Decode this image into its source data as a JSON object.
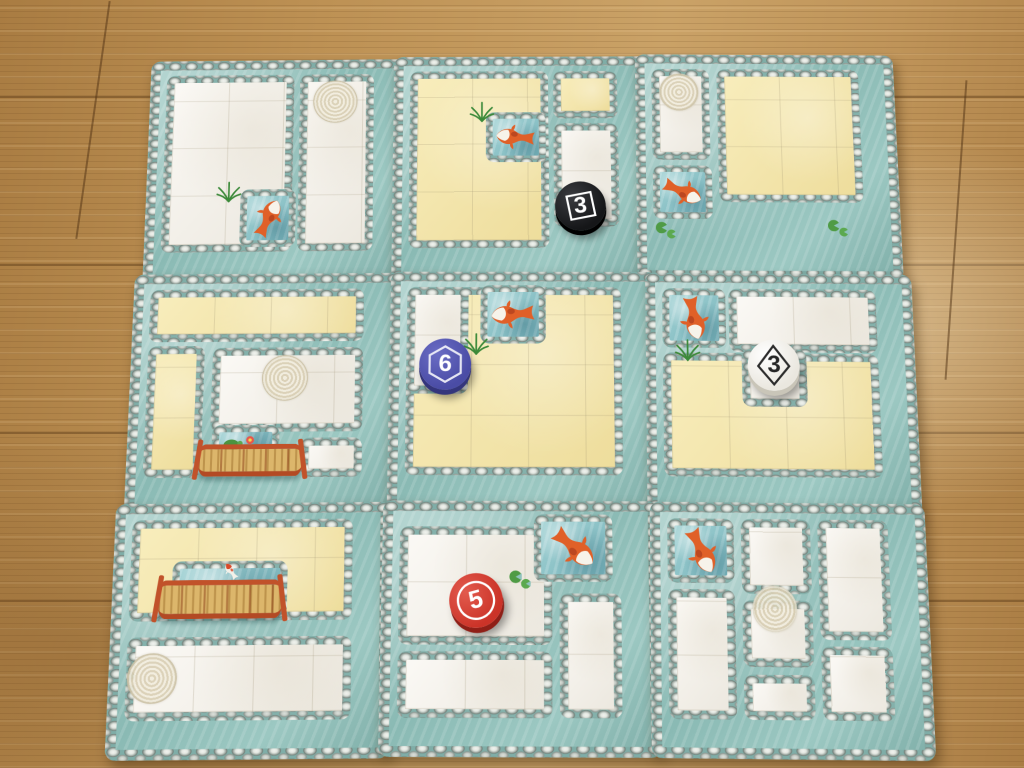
{
  "palette": {
    "floor": "#bd9154",
    "floor_dark": "#8f6536",
    "tile_water": "#9ac5c0",
    "pebble_gray": "#99a39e",
    "pebble_light": "#e4e8e4",
    "garden_white": "#f5f2ec",
    "garden_yellow": "#f3e5a9",
    "token_black": "#1b1c1e",
    "token_blue": "#5254ae",
    "token_white": "#f4f1ea",
    "token_red": "#d23b30",
    "bridge_rail": "#c1522a",
    "bridge_deck": "#dcb66b",
    "koi_orange": "#e06028"
  },
  "board": {
    "rows": 3,
    "cols": 3,
    "tiles": [
      {
        "id": "tile-a",
        "row": 0,
        "col": 0,
        "regions": [
          {
            "x": 0.12,
            "y": 0.12,
            "w": 2.32,
            "h": 3.76,
            "fill": "white"
          },
          {
            "x": 2.54,
            "y": 0.12,
            "w": 1.34,
            "h": 3.76,
            "fill": "white"
          }
        ],
        "features": [
          {
            "type": "spiral",
            "x": 3.18,
            "y": 0.72,
            "r": 0.44
          },
          {
            "type": "pond",
            "x": 1.52,
            "y": 2.58,
            "w": 0.98,
            "h": 1.2,
            "rot": 25
          },
          {
            "type": "plant",
            "x": 1.3,
            "y": 2.58
          }
        ],
        "token": null
      },
      {
        "id": "tile-b",
        "row": 0,
        "col": 1,
        "regions": [
          {
            "x": 0.12,
            "y": 0.12,
            "w": 2.5,
            "h": 3.76,
            "fill": "yellow"
          },
          {
            "x": 2.72,
            "y": 0.12,
            "w": 1.16,
            "h": 1.02,
            "fill": "yellow"
          },
          {
            "x": 2.72,
            "y": 1.24,
            "w": 1.16,
            "h": 2.2,
            "fill": "white"
          }
        ],
        "features": [
          {
            "type": "pond",
            "x": 1.5,
            "y": 1.0,
            "w": 1.08,
            "h": 1.08,
            "rot": -85
          },
          {
            "type": "plant",
            "x": 1.42,
            "y": 0.95
          }
        ],
        "token": {
          "value": "3",
          "color": "black",
          "shape": "square",
          "x": 3.18,
          "y": 3.0,
          "rot": -5
        }
      },
      {
        "id": "tile-c",
        "row": 0,
        "col": 2,
        "regions": [
          {
            "x": 0.12,
            "y": 0.12,
            "w": 1.04,
            "h": 1.95,
            "fill": "white"
          },
          {
            "x": 1.3,
            "y": 0.12,
            "w": 2.58,
            "h": 2.85,
            "fill": "yellow"
          }
        ],
        "features": [
          {
            "type": "spiral",
            "x": 0.62,
            "y": 0.62,
            "r": 0.4
          },
          {
            "type": "pond",
            "x": 0.12,
            "y": 2.2,
            "w": 1.06,
            "h": 1.12,
            "rot": 115
          },
          {
            "type": "lily",
            "x": 0.34,
            "y": 3.56
          },
          {
            "type": "lily",
            "x": 3.4,
            "y": 3.5
          }
        ],
        "token": null
      },
      {
        "id": "tile-d",
        "row": 1,
        "col": 0,
        "regions": [
          {
            "x": 0.12,
            "y": 0.12,
            "w": 3.76,
            "h": 1.06,
            "fill": "yellow"
          },
          {
            "x": 0.12,
            "y": 1.26,
            "w": 1.0,
            "h": 2.62,
            "fill": "yellow"
          },
          {
            "x": 1.26,
            "y": 1.3,
            "w": 2.62,
            "h": 1.7,
            "fill": "white"
          },
          {
            "x": 2.82,
            "y": 3.1,
            "w": 1.06,
            "h": 0.78,
            "fill": "white"
          }
        ],
        "features": [
          {
            "type": "spiral",
            "x": 2.52,
            "y": 1.92,
            "r": 0.45
          },
          {
            "type": "pond",
            "x": 1.28,
            "y": 2.86,
            "w": 1.18,
            "h": 0.6,
            "variant": "flora"
          },
          {
            "type": "bridge",
            "x": 1.06,
            "y": 3.22,
            "w": 1.8,
            "h": 0.64
          }
        ],
        "token": null
      },
      {
        "id": "tile-e",
        "row": 1,
        "col": 1,
        "regions": [
          {
            "x": 0.12,
            "y": 0.12,
            "w": 3.76,
            "h": 3.76,
            "fill": "yellow"
          },
          {
            "x": 0.12,
            "y": 0.12,
            "w": 1.08,
            "h": 2.15,
            "fill": "white"
          }
        ],
        "features": [
          {
            "type": "pond",
            "x": 1.4,
            "y": 0.08,
            "w": 1.16,
            "h": 1.18,
            "rot": -95
          },
          {
            "type": "plant",
            "x": 1.34,
            "y": 1.22
          }
        ],
        "token": {
          "value": "6",
          "color": "blue",
          "shape": "hexagon",
          "x": 0.8,
          "y": 1.68,
          "rot": 0
        }
      },
      {
        "id": "tile-f",
        "row": 1,
        "col": 2,
        "regions": [
          {
            "x": 0.12,
            "y": 1.42,
            "w": 3.76,
            "h": 2.46,
            "fill": "yellow"
          },
          {
            "x": 1.28,
            "y": 0.12,
            "w": 2.6,
            "h": 1.28,
            "fill": "white"
          },
          {
            "x": 1.5,
            "y": 1.34,
            "w": 1.12,
            "h": 1.16,
            "fill": "white"
          }
        ],
        "features": [
          {
            "type": "pond",
            "x": 0.12,
            "y": 0.12,
            "w": 1.12,
            "h": 1.2,
            "rot": 170
          },
          {
            "type": "plant",
            "x": 0.55,
            "y": 1.32
          }
        ],
        "token": {
          "value": "3",
          "color": "white",
          "shape": "diamond",
          "x": 2.06,
          "y": 1.66,
          "rot": 0
        }
      },
      {
        "id": "tile-g",
        "row": 2,
        "col": 0,
        "regions": [
          {
            "x": 0.12,
            "y": 0.12,
            "w": 3.76,
            "h": 1.92,
            "fill": "yellow"
          },
          {
            "x": 0.12,
            "y": 2.34,
            "w": 3.76,
            "h": 1.54,
            "fill": "white"
          }
        ],
        "features": [
          {
            "type": "pond",
            "x": 0.84,
            "y": 0.92,
            "w": 1.95,
            "h": 1.06,
            "variant": "plain"
          },
          {
            "type": "koi-jump",
            "x": 1.82,
            "y": 1.1
          },
          {
            "type": "bridge",
            "x": 0.6,
            "y": 1.26,
            "w": 2.1,
            "h": 0.74
          },
          {
            "type": "spiral",
            "x": 0.56,
            "y": 3.1,
            "r": 0.46
          }
        ],
        "token": null
      },
      {
        "id": "tile-h",
        "row": 2,
        "col": 1,
        "regions": [
          {
            "x": 0.12,
            "y": 0.3,
            "w": 2.6,
            "h": 2.24,
            "fill": "white"
          },
          {
            "x": 0.12,
            "y": 2.66,
            "w": 2.6,
            "h": 1.22,
            "fill": "white"
          },
          {
            "x": 2.84,
            "y": 1.56,
            "w": 1.04,
            "h": 2.32,
            "fill": "white"
          }
        ],
        "features": [
          {
            "type": "pond",
            "x": 2.4,
            "y": 0.06,
            "w": 1.34,
            "h": 1.28,
            "rot": 130
          },
          {
            "type": "lily",
            "x": 2.18,
            "y": 1.3
          }
        ],
        "token": {
          "value": "5",
          "color": "red",
          "shape": "circle",
          "x": 1.42,
          "y": 1.7,
          "rot": -15
        }
      },
      {
        "id": "tile-i",
        "row": 2,
        "col": 2,
        "regions": [
          {
            "x": 1.38,
            "y": 0.12,
            "w": 1.18,
            "h": 1.42,
            "fill": "white"
          },
          {
            "x": 2.68,
            "y": 0.12,
            "w": 1.2,
            "h": 2.28,
            "fill": "white"
          },
          {
            "x": 0.12,
            "y": 1.46,
            "w": 1.14,
            "h": 2.42,
            "fill": "white"
          },
          {
            "x": 1.38,
            "y": 1.66,
            "w": 1.18,
            "h": 1.26,
            "fill": "white"
          },
          {
            "x": 2.68,
            "y": 2.52,
            "w": 1.2,
            "h": 1.36,
            "fill": "white"
          },
          {
            "x": 1.38,
            "y": 3.04,
            "w": 1.18,
            "h": 0.84,
            "fill": "white"
          }
        ],
        "features": [
          {
            "type": "pond",
            "x": 0.12,
            "y": 0.12,
            "w": 1.14,
            "h": 1.22,
            "rot": 155
          },
          {
            "type": "spiral",
            "x": 1.92,
            "y": 1.82,
            "r": 0.42
          }
        ],
        "token": null
      }
    ]
  }
}
